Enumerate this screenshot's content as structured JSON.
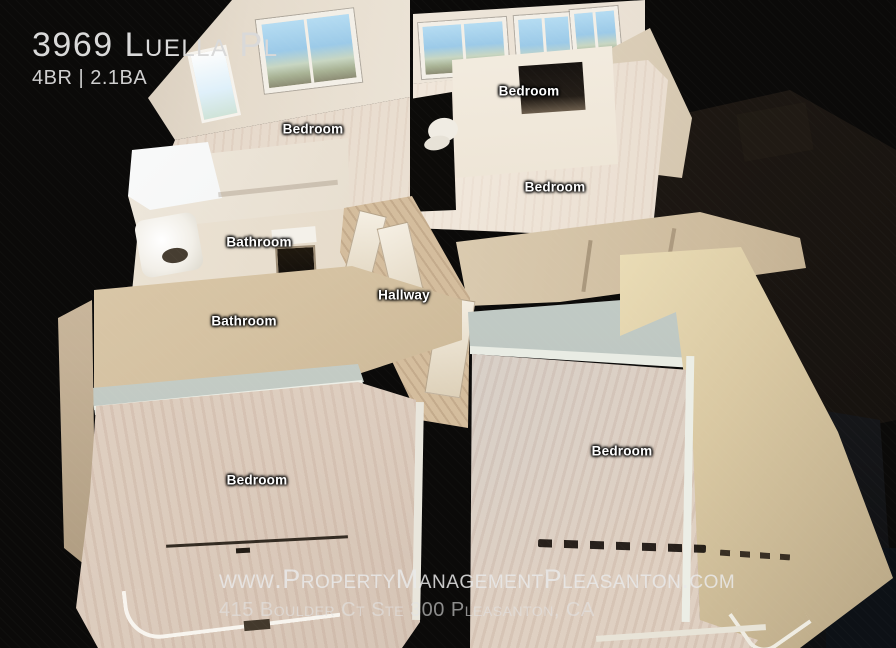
{
  "header": {
    "title": "3969 Luella Pl",
    "specs": "4BR | 2.1BA"
  },
  "room_labels": [
    "Bedroom",
    "Bedroom",
    "Bedroom",
    "Bathroom",
    "Hallway",
    "Bathroom",
    "Bedroom",
    "Bedroom"
  ],
  "watermark": {
    "website": "www.PropertyManagementPleasanton.com",
    "address": "415 Boulder Ct Ste 300 Pleasanton, CA"
  },
  "colors": {
    "background": "#0b0a09",
    "wall_cream": "#e8ddcc",
    "wall_tan": "#d0bc9c",
    "wall_sage": "#c6cec8",
    "floor_wood": "#ddcfc0",
    "floor_hallway": "#d4bd9d",
    "window_sky": "#9ccae8",
    "label_text": "#ffffff",
    "title_text": "#d9d9d9",
    "watermark_text": "#e9e9e9"
  }
}
